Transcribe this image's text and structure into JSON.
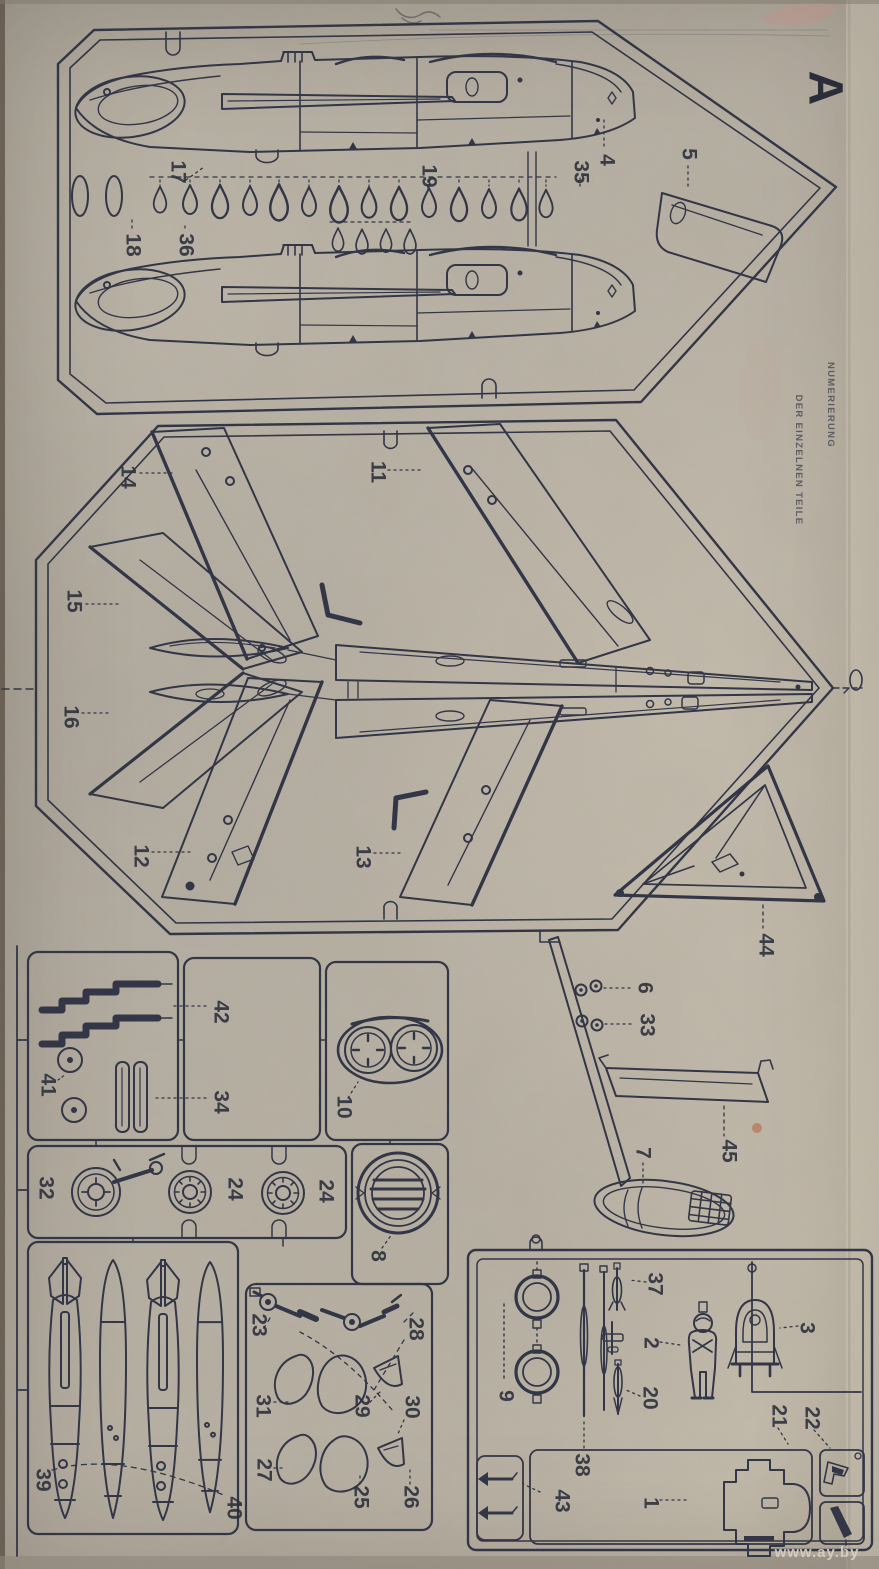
{
  "sheet": {
    "letter": "A",
    "caption": [
      "NUMERIERUNG",
      "DER EINZELNEN TEILE"
    ],
    "watermark": "www.ay.by"
  },
  "colors": {
    "paper": "#b4ada1",
    "paper_light": "#cdc5b3",
    "ink": "#333646",
    "label_ink": "#2b2e3a",
    "stain_pink": "#c98f8a",
    "stain_rust": "#b9603a"
  },
  "sprues": {
    "fuselage_sprue_parts": [
      "4",
      "5",
      "17",
      "18",
      "19",
      "35",
      "36"
    ],
    "wing_sprue_parts": [
      "11",
      "12",
      "13",
      "14",
      "15",
      "16",
      "44"
    ],
    "runner_parts": [
      "6",
      "33",
      "45",
      "7"
    ],
    "small_parts_sprue": [
      "42",
      "34",
      "41",
      "10",
      "32",
      "24",
      "24",
      "8",
      "39",
      "40",
      "23",
      "28",
      "31",
      "29",
      "30",
      "27",
      "25",
      "26"
    ],
    "detail_box_parts": [
      "9",
      "37",
      "2",
      "20",
      "3",
      "21",
      "22",
      "38",
      "43",
      "1"
    ]
  },
  "part_labels": [
    {
      "t": "17",
      "x": 177,
      "y": 172
    },
    {
      "t": "19",
      "x": 428,
      "y": 176
    },
    {
      "t": "35",
      "x": 580,
      "y": 172
    },
    {
      "t": "4",
      "x": 606,
      "y": 160
    },
    {
      "t": "36",
      "x": 185,
      "y": 245
    },
    {
      "t": "18",
      "x": 132,
      "y": 245
    },
    {
      "t": "5",
      "x": 688,
      "y": 154
    },
    {
      "t": "14",
      "x": 127,
      "y": 477
    },
    {
      "t": "11",
      "x": 377,
      "y": 472
    },
    {
      "t": "15",
      "x": 73,
      "y": 601
    },
    {
      "t": "16",
      "x": 70,
      "y": 717
    },
    {
      "t": "12",
      "x": 140,
      "y": 856
    },
    {
      "t": "13",
      "x": 362,
      "y": 857
    },
    {
      "t": "44",
      "x": 765,
      "y": 945
    },
    {
      "t": "6",
      "x": 644,
      "y": 988
    },
    {
      "t": "33",
      "x": 646,
      "y": 1025
    },
    {
      "t": "45",
      "x": 728,
      "y": 1151
    },
    {
      "t": "7",
      "x": 642,
      "y": 1153
    },
    {
      "t": "42",
      "x": 220,
      "y": 1012
    },
    {
      "t": "34",
      "x": 220,
      "y": 1102
    },
    {
      "t": "41",
      "x": 47,
      "y": 1085
    },
    {
      "t": "10",
      "x": 343,
      "y": 1107
    },
    {
      "t": "32",
      "x": 45,
      "y": 1188
    },
    {
      "t": "24",
      "x": 234,
      "y": 1189
    },
    {
      "t": "24",
      "x": 325,
      "y": 1191
    },
    {
      "t": "8",
      "x": 377,
      "y": 1256
    },
    {
      "t": "39",
      "x": 42,
      "y": 1480
    },
    {
      "t": "40",
      "x": 233,
      "y": 1508
    },
    {
      "t": "23",
      "x": 258,
      "y": 1325
    },
    {
      "t": "28",
      "x": 415,
      "y": 1329
    },
    {
      "t": "31",
      "x": 262,
      "y": 1406
    },
    {
      "t": "29",
      "x": 361,
      "y": 1406
    },
    {
      "t": "30",
      "x": 411,
      "y": 1407
    },
    {
      "t": "27",
      "x": 263,
      "y": 1470
    },
    {
      "t": "25",
      "x": 360,
      "y": 1497
    },
    {
      "t": "26",
      "x": 410,
      "y": 1497
    },
    {
      "t": "9",
      "x": 505,
      "y": 1396
    },
    {
      "t": "37",
      "x": 654,
      "y": 1284
    },
    {
      "t": "2",
      "x": 650,
      "y": 1343
    },
    {
      "t": "20",
      "x": 649,
      "y": 1398
    },
    {
      "t": "3",
      "x": 806,
      "y": 1328
    },
    {
      "t": "21",
      "x": 778,
      "y": 1416
    },
    {
      "t": "22",
      "x": 811,
      "y": 1418
    },
    {
      "t": "38",
      "x": 581,
      "y": 1465
    },
    {
      "t": "43",
      "x": 561,
      "y": 1501
    },
    {
      "t": "1",
      "x": 650,
      "y": 1503
    }
  ]
}
